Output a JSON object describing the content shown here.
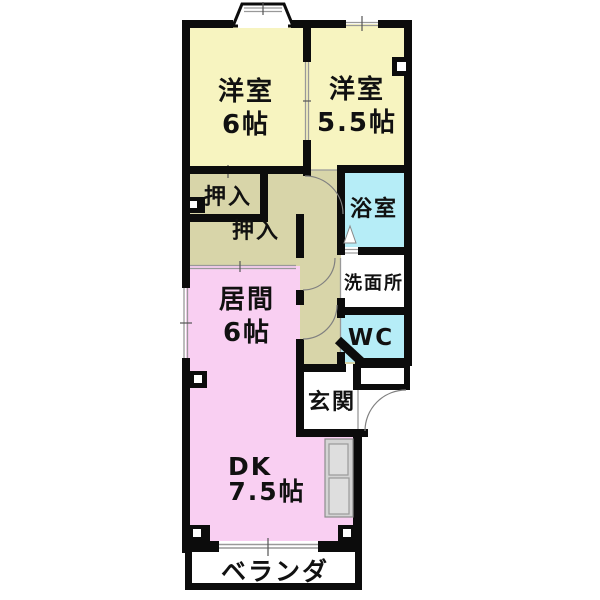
{
  "plan": {
    "type": "floorplan-2DK",
    "rooms": {
      "bedroom1": {
        "name": "洋室",
        "size": "6帖"
      },
      "bedroom2": {
        "name": "洋室",
        "size": "5.5帖"
      },
      "closet_upper": {
        "name": "押入"
      },
      "closet_lower": {
        "name": "押入"
      },
      "bath": {
        "name": "浴室"
      },
      "washroom": {
        "name": "洗面所"
      },
      "wc": {
        "name": "WC"
      },
      "living": {
        "name": "居間",
        "size": "6帖"
      },
      "entrance": {
        "name": "玄関"
      },
      "dining_kitchen": {
        "name": "DK",
        "size": "7.5帖"
      },
      "balcony": {
        "name": "ベランダ"
      }
    },
    "colors": {
      "bedroom_fill": "#f7f4c0",
      "tatami_closet_hall_fill": "#d8d5a9",
      "living_dk_fill": "#f9cff2",
      "bath_wc_fill": "#b6edf7",
      "wall": "#0c0c0c",
      "counter_gray": "#d4d4d4",
      "background": "#ffffff"
    }
  }
}
